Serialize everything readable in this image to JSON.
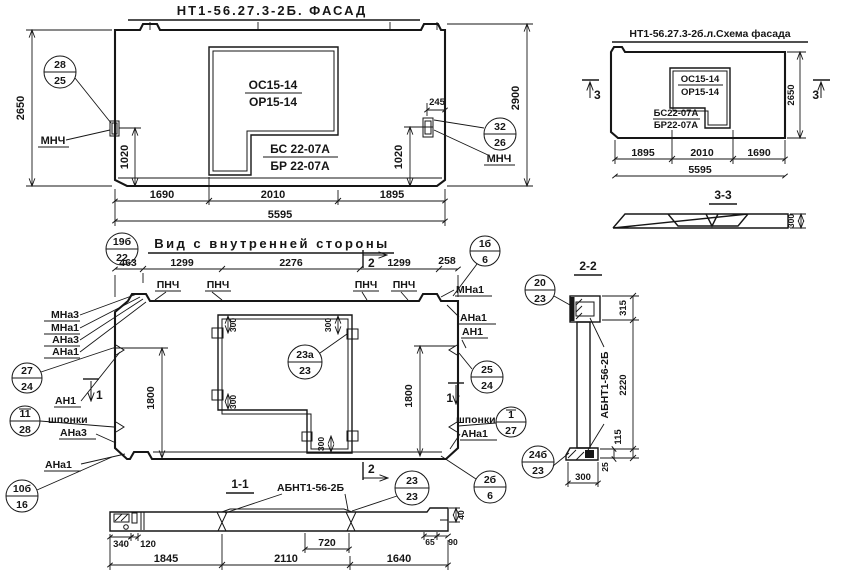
{
  "facade": {
    "title": "НТ1-56.27.3-2Б. ФАСАД",
    "oc": "ОС15-14",
    "op": "ОР15-14",
    "bs": "БС 22-07А",
    "br": "БР 22-07А",
    "mnch": "МНЧ",
    "c28": {
      "top": "28",
      "bot": "25"
    },
    "c32": {
      "top": "32",
      "bot": "26"
    },
    "d2650": "2650",
    "d2900": "2900",
    "d1020": "1020",
    "d245": "245",
    "d1690": "1690",
    "d2010": "2010",
    "d1895": "1895",
    "d5595": "5595"
  },
  "schema": {
    "title": "НТ1-56.27.3-2б.л.Схема фасада",
    "oc": "ОС15-14",
    "op": "ОР15-14",
    "bs": "БС22-07А",
    "br": "БР22-07А",
    "mark3": "3",
    "d2650": "2650",
    "d1895": "1895",
    "d2010": "2010",
    "d1690": "1690",
    "d5595": "5595",
    "s33": {
      "title": "3-3",
      "d300": "300"
    }
  },
  "inner": {
    "title": "Вид с внутренней стороны",
    "c19": {
      "top": "19б",
      "bot": "22"
    },
    "d463": "463",
    "d1299": "1299",
    "d2276": "2276",
    "d258": "258",
    "pnch": "ПНЧ",
    "mark2": "2",
    "mark1": "1",
    "lbl": {
      "mna3": "МНа3",
      "mna1": "МНа1",
      "ana3": "АНа3",
      "ana1": "АНа1",
      "an1": "АН1",
      "shponki": "шпонки"
    },
    "d1800": "1800",
    "d300": "300",
    "c27": {
      "top": "27",
      "bot": "24"
    },
    "c11": {
      "top": "11",
      "bot": "28"
    },
    "c10": {
      "top": "10б",
      "bot": "16"
    },
    "c23a": {
      "top": "23а",
      "bot": "23"
    },
    "c1b": {
      "top": "1б",
      "bot": "6"
    },
    "c25": {
      "top": "25",
      "bot": "24"
    },
    "c1o": {
      "top": "1",
      "bot": "27"
    },
    "c2b": {
      "top": "2б",
      "bot": "6"
    }
  },
  "s11": {
    "title": "1-1",
    "label": "АБНТ1-56-2Б",
    "c23": {
      "top": "23",
      "bot": "23"
    },
    "d340": "340",
    "d120": "120",
    "d720": "720",
    "d65": "65",
    "d90": "90",
    "d40": "40",
    "d1845": "1845",
    "d2110": "2110",
    "d1640": "1640"
  },
  "s22": {
    "title": "2-2",
    "label": "АБНТ1-56-2Б",
    "c20": {
      "top": "20",
      "bot": "23"
    },
    "c24": {
      "top": "24б",
      "bot": "23"
    },
    "d315": "315",
    "d2220": "2220",
    "d115": "115",
    "d25": "25",
    "d300": "300"
  }
}
